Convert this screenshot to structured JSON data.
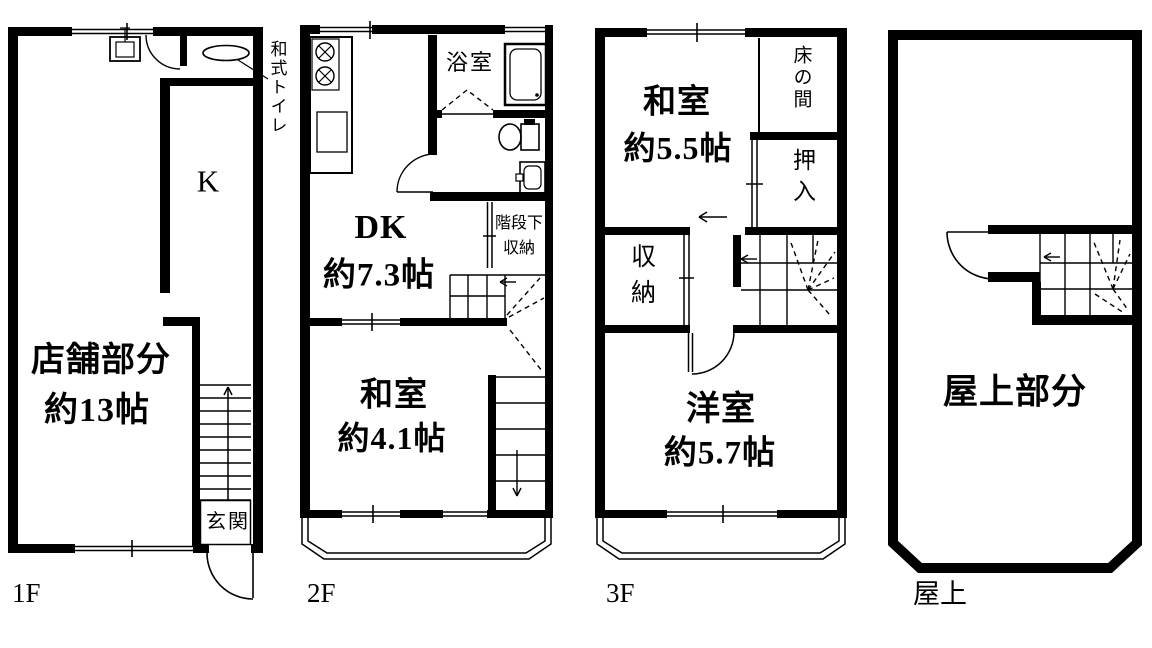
{
  "f1": {
    "floor": "1F",
    "shop": "店舗部分",
    "shop_size": "約13帖",
    "kitchen": "K",
    "toilet": "和式トイレ",
    "entrance": "玄関"
  },
  "f2": {
    "floor": "2F",
    "bathroom": "浴室",
    "dk": "DK",
    "dk_size": "約7.3帖",
    "understair1": "階段下",
    "understair2": "収納",
    "washitsu": "和室",
    "washitsu_size": "約4.1帖"
  },
  "f3": {
    "floor": "3F",
    "washitsu": "和室",
    "washitsu_size": "約5.5帖",
    "tokonoma": "床の間",
    "oshiire": "押入",
    "storage": "収納",
    "youshitsu": "洋室",
    "youshitsu_size": "約5.7帖"
  },
  "roof": {
    "floor": "屋上",
    "area": "屋上部分"
  },
  "colors": {
    "line": "#000000",
    "bg": "#ffffff"
  }
}
